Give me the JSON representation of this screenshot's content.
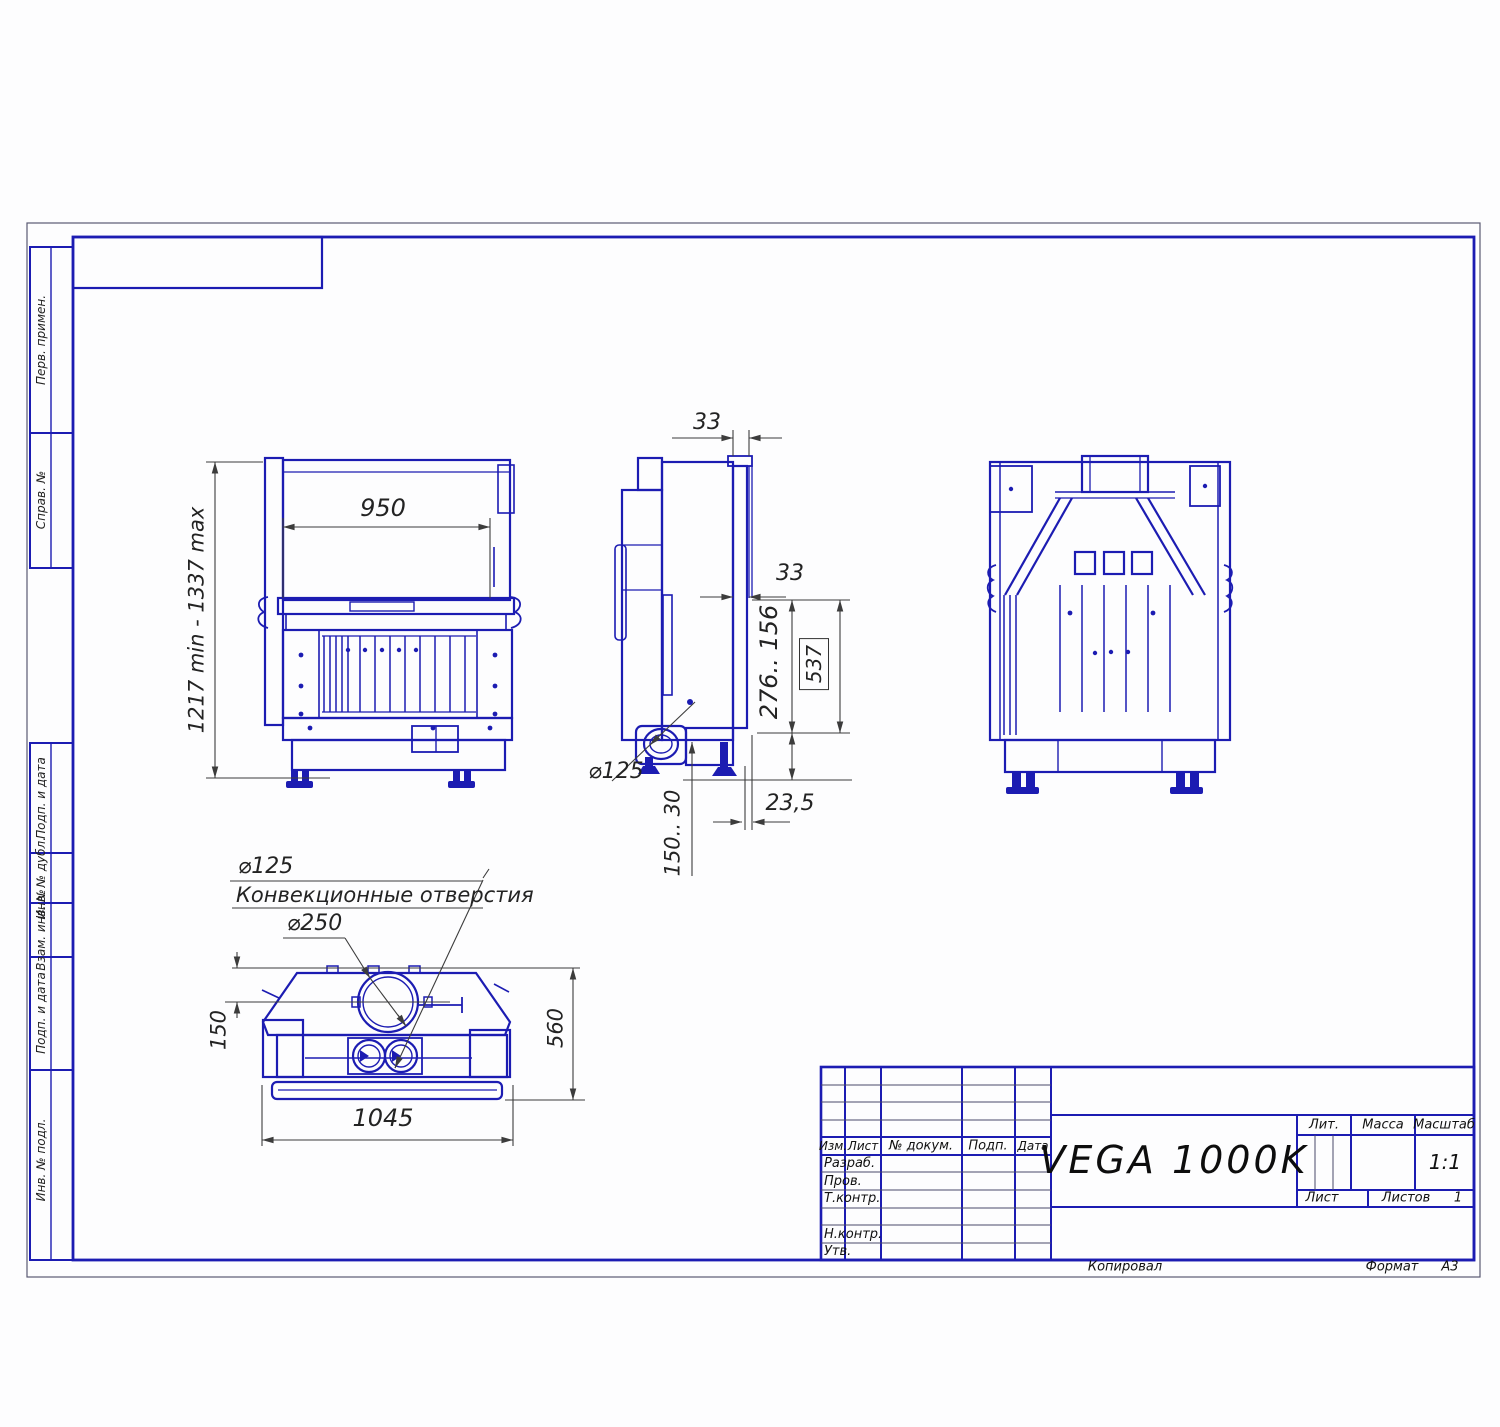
{
  "drawing": {
    "title": "VEGA 1000K",
    "scale_value": "1:1",
    "sheets_value": "1",
    "copied": "Копировал",
    "format_label": "Формат",
    "format_value": "А3"
  },
  "title_block": {
    "cols": [
      "Изм.",
      "Лист",
      "№ докум.",
      "Подп.",
      "Дата"
    ],
    "rows": [
      "Разраб.",
      "Пров.",
      "Т.контр.",
      "Н.контр.",
      "Утв."
    ],
    "lit_label": "Лит.",
    "mass_label": "Масса",
    "scale_label": "Масштаб",
    "sheet_label": "Лист",
    "sheets_label": "Листов"
  },
  "margin": {
    "top": [
      "Перв. примен.",
      "Справ. №"
    ],
    "bottom": [
      "Подп. и дата",
      "Инв. № дубл.",
      "Взам. инв. №",
      "Подп. и дата",
      "Инв. № подл."
    ]
  },
  "dims": {
    "front_width": "950",
    "front_height": "1217 min - 1337 max",
    "gap_top": "33",
    "gap_mid": "33",
    "depth_range": "276.. 156",
    "depth_ref": "537",
    "outlet_dia": "⌀125",
    "front_gap": "23,5",
    "leg_range": "150.. 30",
    "conv_dia": "⌀125",
    "conv_note": "Конвекционные отверстия",
    "flue_dia": "⌀250",
    "back_offset": "150",
    "total_depth": "560",
    "bottom_width": "1045"
  }
}
